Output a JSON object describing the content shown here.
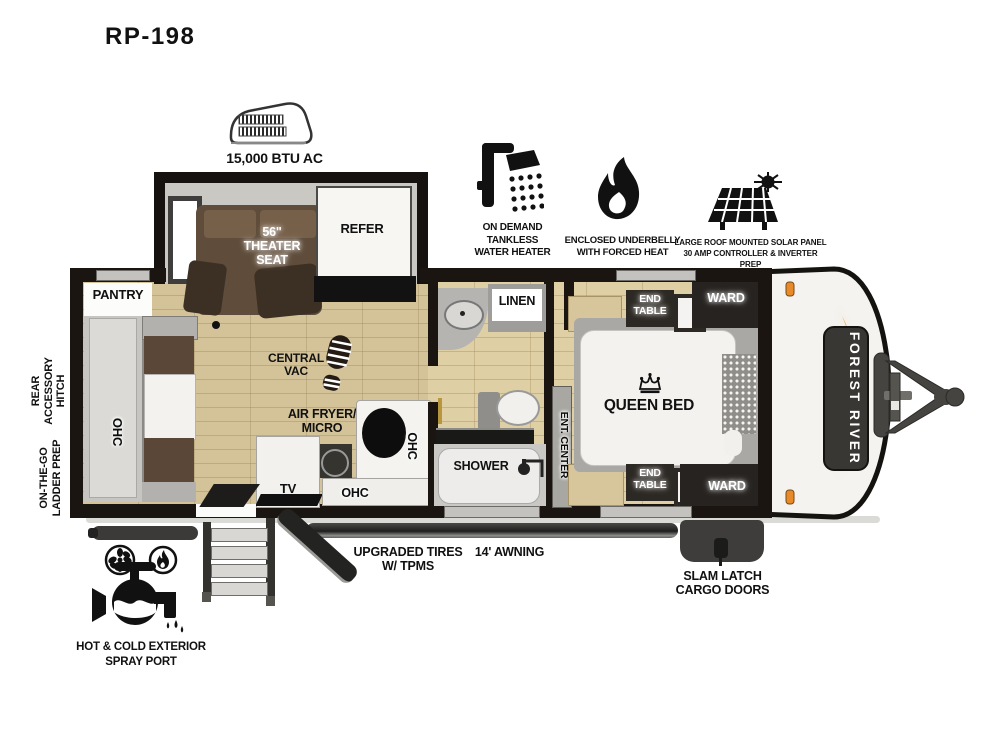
{
  "title": "RP-198",
  "ac": {
    "label": "15,000 BTU AC"
  },
  "features": [
    {
      "icon": "shower-head-icon",
      "label": "ON DEMAND\nTANKLESS\nWATER HEATER"
    },
    {
      "icon": "flame-icon",
      "label": "ENCLOSED UNDERBELLY\nWITH FORCED HEAT"
    },
    {
      "icon": "solar-panel-icon",
      "label": "LARGE ROOF MOUNTED SOLAR PANEL\n30 AMP CONTROLLER & INVERTER PREP"
    }
  ],
  "rooms": {
    "pantry": "PANTRY",
    "ohc": "OHC",
    "theater_seat": "56\"\nTHEATER\nSEAT",
    "refer": "REFER",
    "central_vac": "CENTRAL\nVAC",
    "air_fryer": "AIR FRYER/\nMICRO",
    "tv": "TV",
    "linen": "LINEN",
    "shower": "SHOWER",
    "ent_center": "ENT. CENTER",
    "queen_bed": "QUEEN BED",
    "end_table": "END\nTABLE",
    "ward": "WARD"
  },
  "exterior": {
    "brand": "FOREST RIVER",
    "rear_hitch": "REAR\nACCESSORY\nHITCH",
    "ladder_prep": "ON-THE-GO\nLADDER PREP",
    "tires": "UPGRADED TIRES\nW/ TPMS",
    "awning": "14' AWNING",
    "cargo": "SLAM LATCH\nCARGO DOORS",
    "spray_port": "HOT & COLD EXTERIOR\nSPRAY PORT"
  },
  "colors": {
    "accent_orange": "#EDA43E",
    "wall_black": "#1A1511",
    "floor_beige": "#DFCFA4",
    "furniture_brown": "#5F4C3A",
    "cabinet_white": "#F4F3F0",
    "dark_cabinet": "#29251F"
  }
}
